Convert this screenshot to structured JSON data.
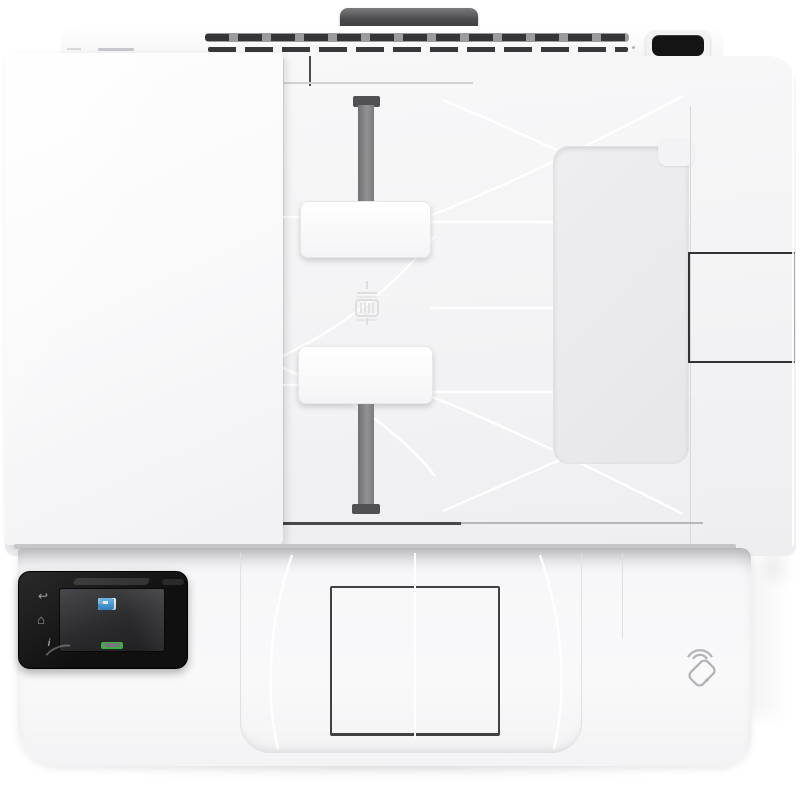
{
  "image": {
    "type": "product-photo",
    "subject": "White multifunction laser printer viewed from directly above",
    "orientation": "top-down"
  },
  "colors": {
    "body_white": "#f6f6f8",
    "recess_gray": "#e9e9ec",
    "vent_gray": "#9b9b9e",
    "dark_trim": "#3c3c3f",
    "panel_black": "#161616",
    "screen_bg": "#2e2e30",
    "app_icon_blue": "#4aa3dc",
    "status_green": "#3fae49",
    "emboss_gray": "#b4b4b8"
  },
  "control_panel": {
    "buttons": [
      {
        "icon": "back-arrow-icon",
        "glyph": "↩"
      },
      {
        "icon": "home-icon",
        "glyph": "⌂"
      },
      {
        "icon": "info-icon",
        "glyph": "i"
      }
    ],
    "screen": {
      "apps": [
        {
          "icon": "copy-icon",
          "label": "Copy"
        },
        {
          "icon": "scan-icon",
          "label": "Scan"
        },
        {
          "icon": "fax-icon",
          "label": "Fax"
        }
      ],
      "status_badge": {
        "icon": "toner-status-badge",
        "color": "#3fae49"
      }
    }
  },
  "hardware": {
    "adf_guides": [
      {
        "name": "paper-guide-upper"
      },
      {
        "name": "paper-guide-lower"
      }
    ],
    "nfc": {
      "icon": "nfc-tap-icon"
    }
  }
}
